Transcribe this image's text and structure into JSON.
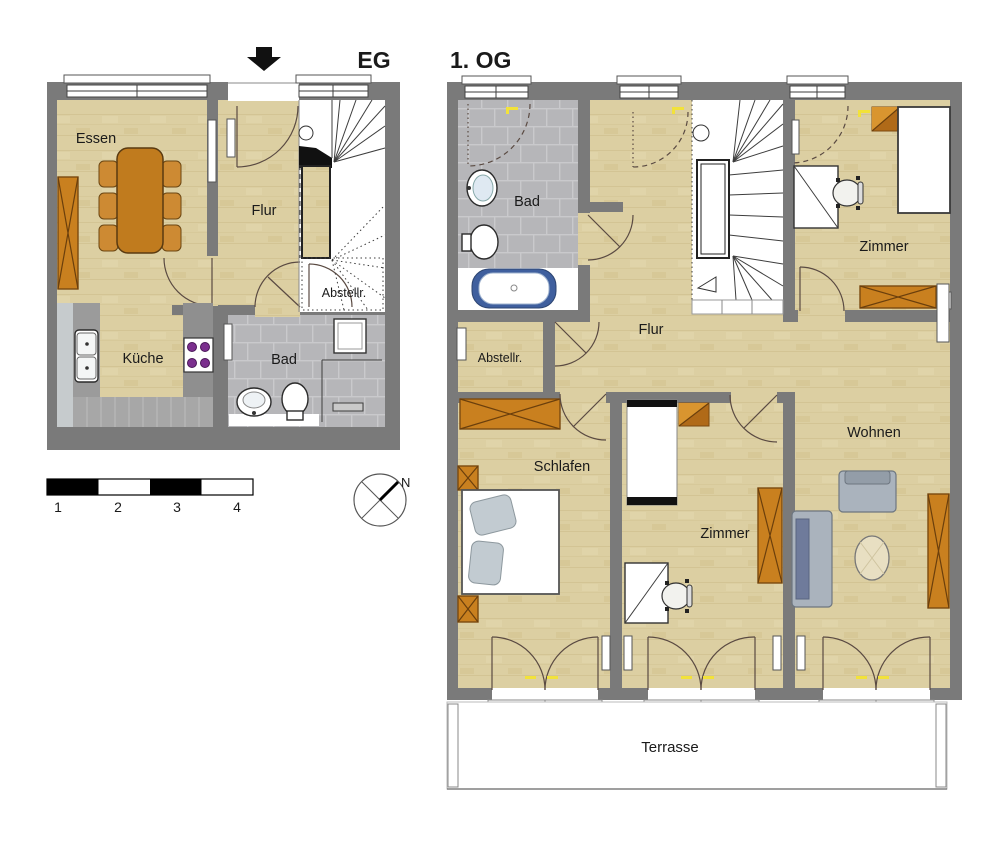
{
  "plans": {
    "eg": {
      "title": "EG",
      "rooms": {
        "essen": "Essen",
        "flur": "Flur",
        "abstellraum": "Abstellr.",
        "kueche": "Küche",
        "bad": "Bad"
      }
    },
    "og": {
      "title": "1. OG",
      "rooms": {
        "bad": "Bad",
        "flur": "Flur",
        "abstellraum": "Abstellr.",
        "zimmer_top": "Zimmer",
        "schlafen": "Schlafen",
        "zimmer_mid": "Zimmer",
        "wohnen": "Wohnen",
        "terrasse": "Terrasse"
      }
    }
  },
  "legend": {
    "scale_labels": [
      "1",
      "2",
      "3",
      "4"
    ],
    "compass_north": "N"
  },
  "colors": {
    "wall": "#7a7a7a",
    "wood_floor": "#dccfa2",
    "tile_floor": "#b6b6b9",
    "furniture_wood": "#c9801f",
    "upholstery": "#aab3bd",
    "stove_burner": "#7b2f8e",
    "bathtub_accent": "#3f5f9e",
    "switch_yellow": "#f2e23a"
  }
}
